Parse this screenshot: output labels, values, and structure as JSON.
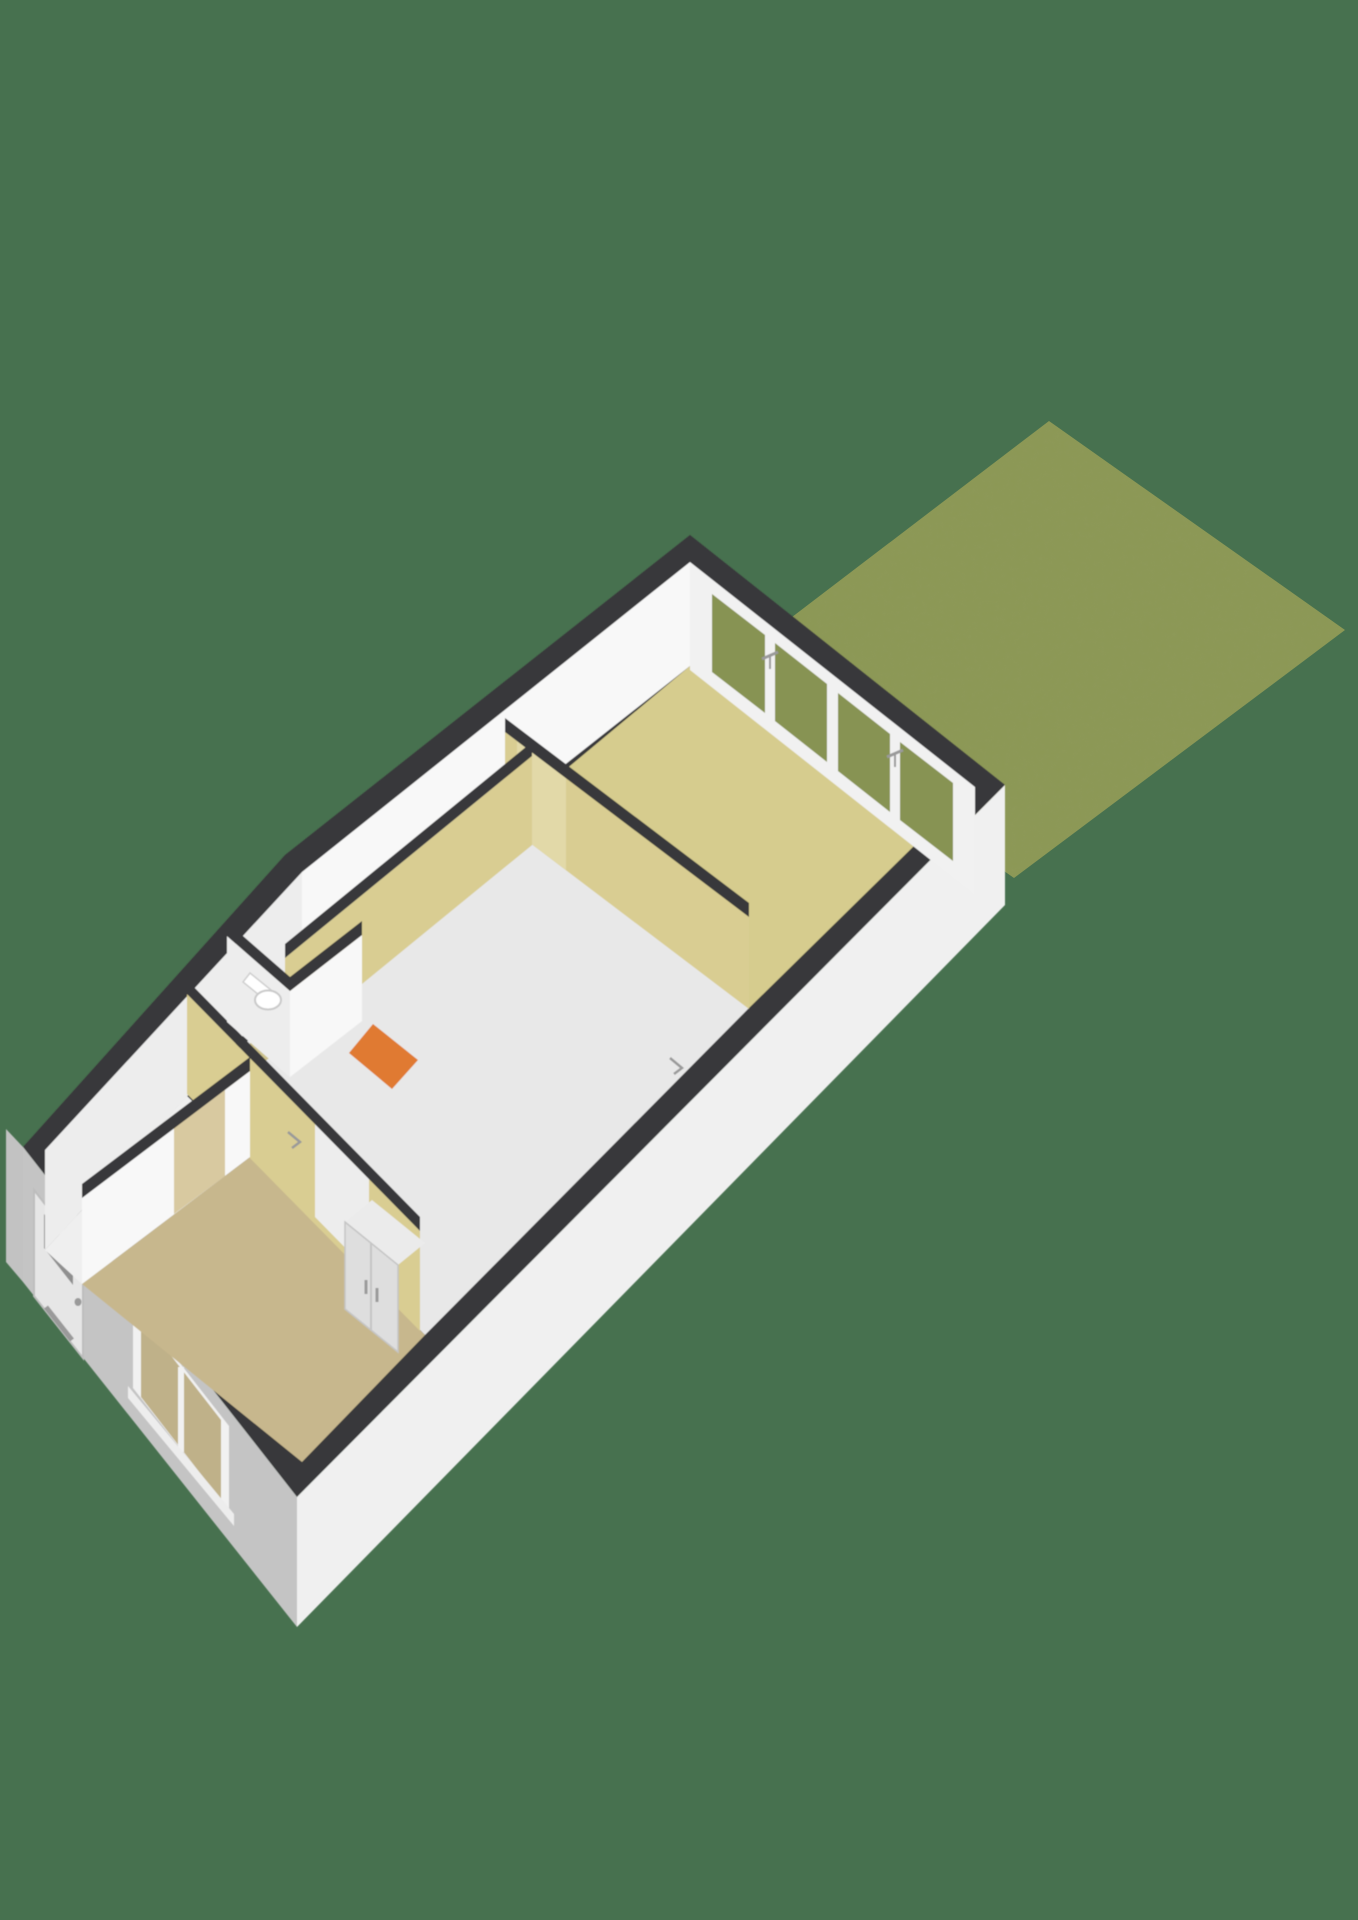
{
  "scene": {
    "kind": "3d-floorplan-render",
    "floor_label": "ground-floor-with-garden",
    "text_visible": "none"
  },
  "colors": {
    "background": "#47714F",
    "grass": "#8C9855",
    "grass_grain": "#55632A",
    "wall_top": "#39393B",
    "facade_se": "#F5F5F5",
    "facade_sw": "#CFCFCF",
    "facade_nw": "#C2C2C2",
    "inner_wall": "#F8F8F8",
    "inner_wall_shade": "#EDEDED",
    "accent_wall": "#D9CD92",
    "floor_living": "#D6CC8E",
    "floor_corridor": "#CDC28D",
    "floor_middle": "#E8E8E8",
    "floor_bedroom": "#C7B78D",
    "floor_hall": "#EFEFEF",
    "floor_toilet": "#F2F2F2",
    "stairs": "#E07A30",
    "glass": "#879352",
    "frame": "#F1F1F1",
    "wardrobe": "#DEDEDE",
    "wardrobe_top": "#EBEBEB",
    "door": "#E6E6E6",
    "door_panel": "#8F8F8F",
    "window_glass_sw": "#BFB189",
    "fixture": "#FFFFFF",
    "hardware": "#9A9A9A",
    "doorway_living": "#E2D9A8",
    "doorway_middle": "#EDEDED",
    "doorway_bedroom": "#D8C9A0",
    "sill": "#EDEDED"
  },
  "rooms": [
    {
      "id": "garden",
      "floor": "grass"
    },
    {
      "id": "living-room",
      "floor": "floor_living"
    },
    {
      "id": "middle-room",
      "floor": "floor_middle"
    },
    {
      "id": "corridor",
      "floor": "floor_corridor"
    },
    {
      "id": "hall",
      "floor": "floor_hall"
    },
    {
      "id": "toilet",
      "floor": "floor_toilet"
    },
    {
      "id": "bedroom",
      "floor": "floor_bedroom"
    }
  ],
  "features": [
    "garden-grass",
    "french-door-wall",
    "front-door",
    "bedroom-window",
    "stairs",
    "wardrobe",
    "toilet-fixture"
  ]
}
